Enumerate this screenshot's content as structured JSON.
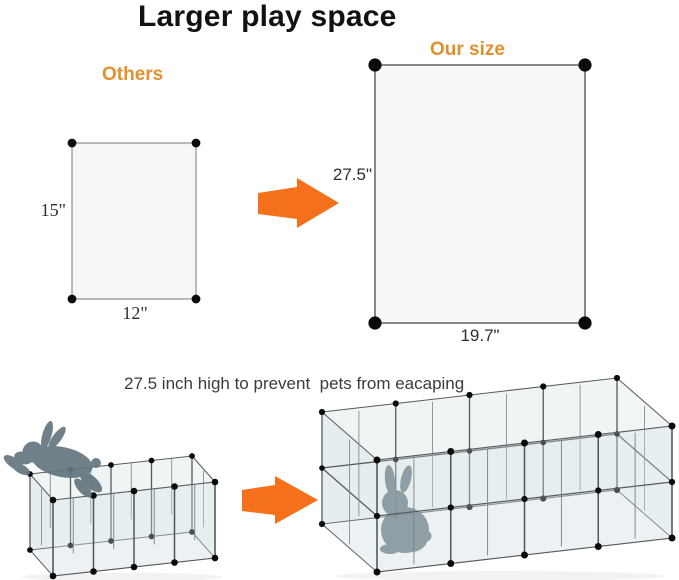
{
  "title": "Larger play space",
  "comparison": {
    "others_label": "Others",
    "our_size_label": "Our size",
    "others_panel": {
      "height": "15\"",
      "width": "12\""
    },
    "our_panel": {
      "height": "27.5\"",
      "width": "19.7\""
    }
  },
  "caption": "27.5 inch high to prevent  pets from eacaping",
  "colors": {
    "accent_orange": "#E0912E",
    "arrow_orange": "#F5701A",
    "rabbit_gray": "#64757E",
    "panel_fill": "#F7F7F7",
    "panel_border_small": "#8F8F8F",
    "panel_border_large": "#4A4A4A",
    "dot_black": "#0B0B0B",
    "pen_edge": "#565B5E"
  },
  "icons": {
    "arrow_top": "right-arrow-icon",
    "arrow_bottom": "right-arrow-icon",
    "rabbit_left": "rabbit-escaping-silhouette",
    "rabbit_right": "rabbit-inside-silhouette"
  }
}
